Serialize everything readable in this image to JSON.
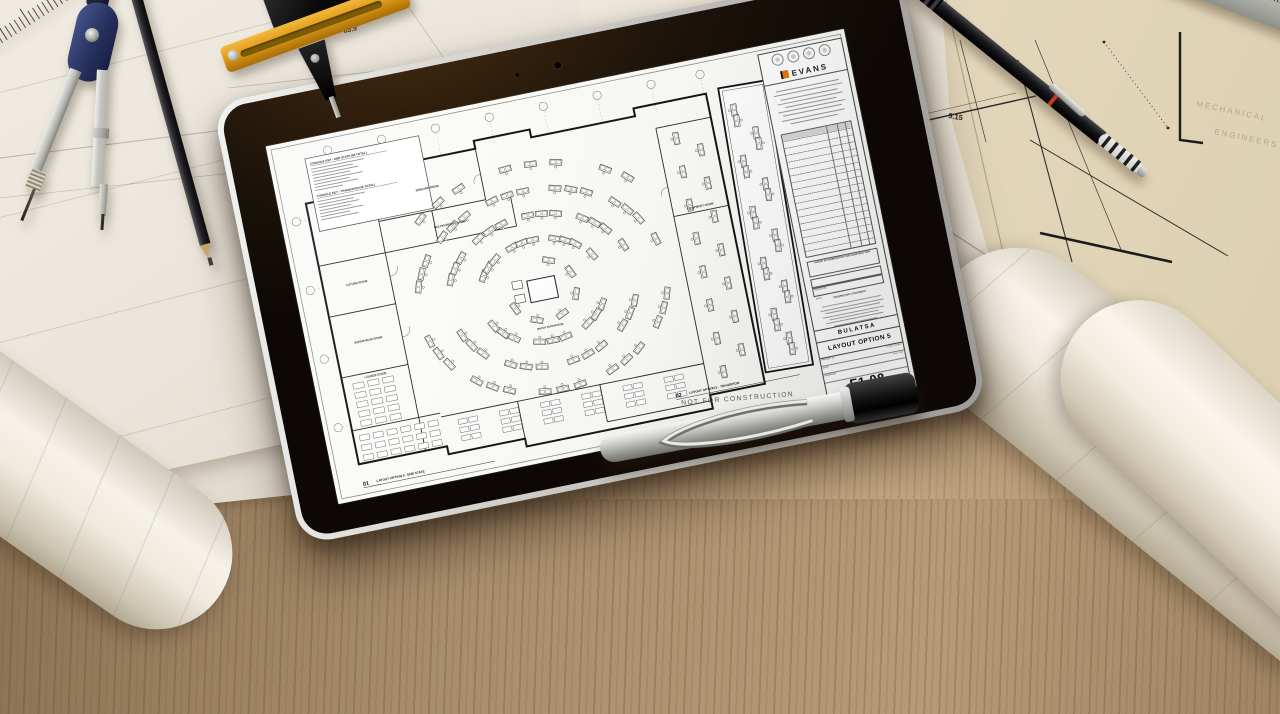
{
  "tablet_screen": {
    "brand": "EVANS",
    "legend_titles": {
      "end_state": "CONSOLE KEY - END STATE (56 TOTAL)",
      "transition": "CONSOLE KEY - TRANSITION (36 TOTAL)"
    },
    "room_labels": [
      "BRIEFING ROOM",
      "MULTIPURPOSE ROOM",
      "FUTURE ROOM",
      "SUPERVISOR ROOM",
      "LOUNGE ROOM",
      "EQUIPMENT ROOM",
      "WATCH SUPERVISOR"
    ],
    "views": [
      {
        "number": "01",
        "title": "LAYOUT OPTION 5 - END STATE"
      },
      {
        "number": "02",
        "title": "LAYOUT OPTION 5 - TRANSITION"
      }
    ],
    "stamp": "NOT FOR CONSTRUCTION",
    "title_block": {
      "client": "BULATSA",
      "sheet_title": "LAYOUT OPTION 5",
      "sheet_number": "F1.08",
      "authorization": "CLIENT AUTHORIZATION FOR CONSTRUCTION",
      "signature_label": "SIGNATURE",
      "date_label": "DATE",
      "proprietary_heading": "PROPRIETARY STATEMENT",
      "fields": [
        {
          "label": "PROJECT ID",
          "value": "Project Number"
        },
        {
          "label": "DATE",
          "value": "Issue Date"
        },
        {
          "label": "DRAWN BY",
          "value": ""
        }
      ]
    }
  },
  "desk": {
    "ruler_numbers": [
      "30",
      "31"
    ],
    "dimension_texts": [
      "83.9",
      "8.18",
      "9.15"
    ],
    "blueprint_words": [
      "MECHANICAL",
      "ENGINEERS",
      "COMPU"
    ]
  },
  "palette": {
    "wood": "#a98e6e",
    "paper": "#ece7dd",
    "blueprint": "#e9dec6",
    "bezel": "#17110b",
    "tablet_edge": "#d8d7d3",
    "compass_blue": "#2c3763",
    "tool_yellow": "#e3a41f",
    "logo_orange": "#e07818"
  }
}
